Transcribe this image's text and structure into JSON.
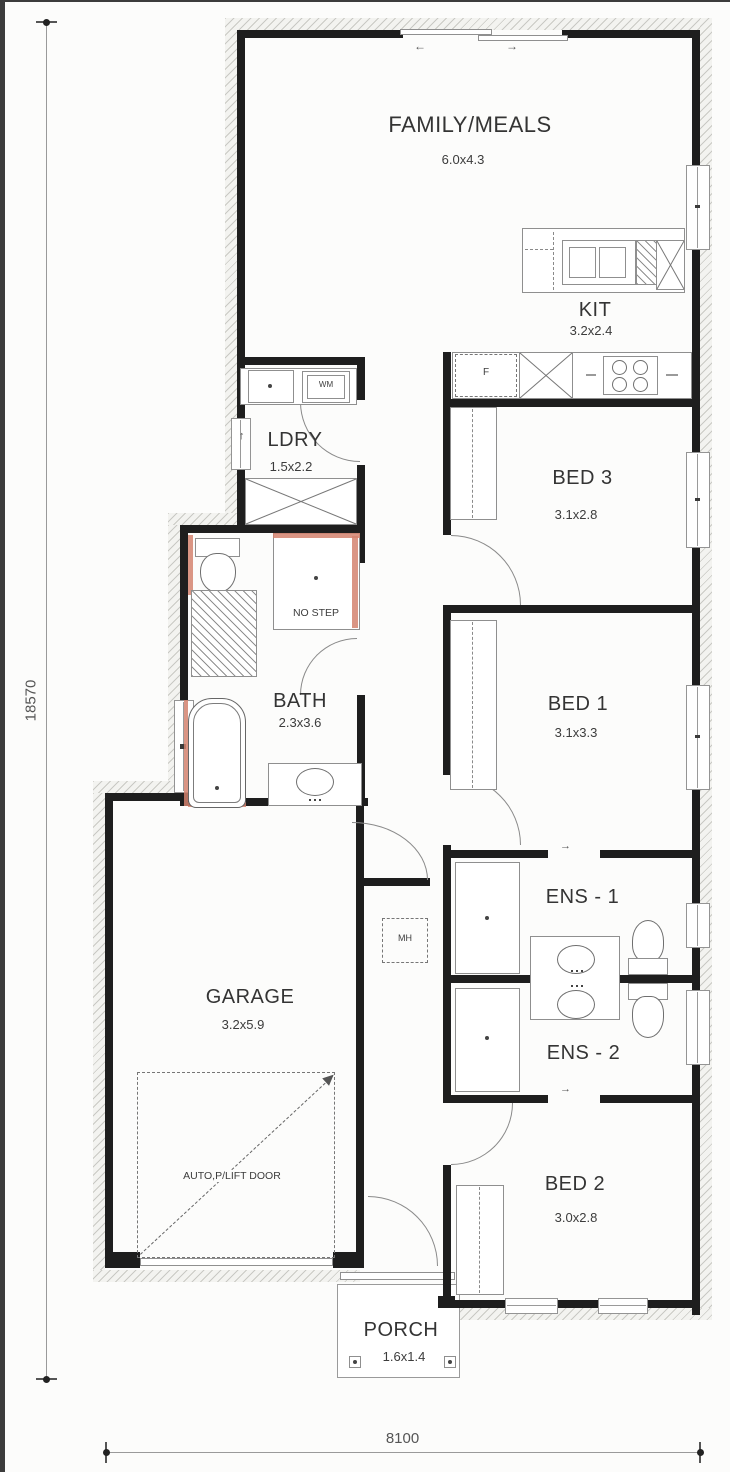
{
  "plan": {
    "rooms": [
      {
        "id": "family",
        "name": "FAMILY/MEALS",
        "dims": "6.0x4.3"
      },
      {
        "id": "kit",
        "name": "KIT",
        "dims": "3.2x2.4"
      },
      {
        "id": "ldry",
        "name": "LDRY",
        "dims": "1.5x2.2"
      },
      {
        "id": "bed3",
        "name": "BED 3",
        "dims": "3.1x2.8"
      },
      {
        "id": "bed1",
        "name": "BED 1",
        "dims": "3.1x3.3"
      },
      {
        "id": "bath",
        "name": "BATH",
        "dims": "2.3x3.6"
      },
      {
        "id": "ens1",
        "name": "ENS - 1",
        "dims": ""
      },
      {
        "id": "ens2",
        "name": "ENS - 2",
        "dims": ""
      },
      {
        "id": "garage",
        "name": "GARAGE",
        "dims": "3.2x5.9"
      },
      {
        "id": "bed2",
        "name": "BED 2",
        "dims": "3.0x2.8"
      },
      {
        "id": "porch",
        "name": "PORCH",
        "dims": "1.6x1.4"
      }
    ],
    "annotations": {
      "no_step": "NO STEP",
      "auto_door": "AUTO,P/LIFT DOOR",
      "mh": "MH",
      "wm": "WM",
      "fridge": "F",
      "arrow_up": "↑",
      "arrow_left": "←",
      "arrow_right": "→"
    },
    "dimensions": {
      "overall_depth": "18570",
      "overall_width": "8100"
    },
    "colors": {
      "wall": "#1e1e1e",
      "wet_area_accent": "#d4826e",
      "label_text": "#343434",
      "dim_text": "#555555"
    }
  }
}
